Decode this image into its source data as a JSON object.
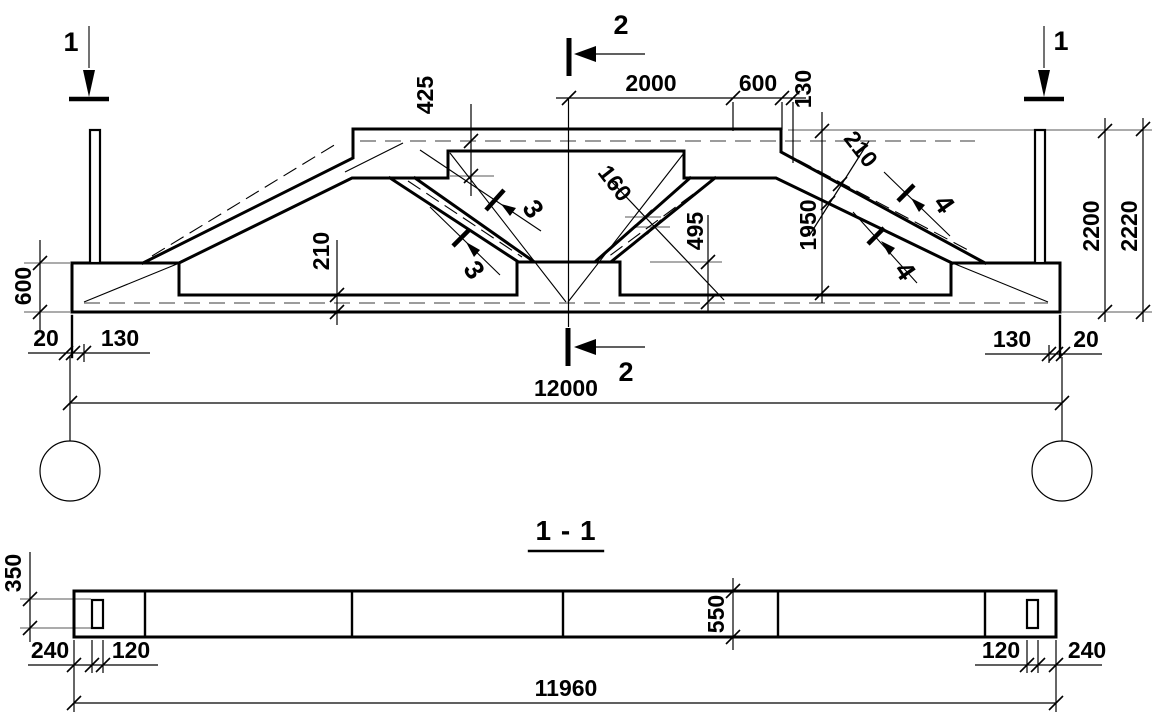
{
  "colors": {
    "ink": "#000000",
    "aux": "#8f8f8f",
    "background": "#ffffff"
  },
  "views": {
    "elevation": {
      "cut_labels": {
        "one": "1",
        "two": "2",
        "three": "3",
        "four": "4"
      },
      "dims": {
        "top_half_span": "2000",
        "top_offset": "600",
        "top_edge": "130",
        "flange_depth": "425",
        "web_thickness": "160",
        "node_height": "495",
        "bottom_chord": "210",
        "top_chord": "210",
        "clear_height": "1950",
        "height": "2200",
        "overall_height": "2220",
        "end_depth": "600",
        "gap_left": "20",
        "edge_left": "130",
        "edge_right": "130",
        "gap_right": "20",
        "span": "12000"
      }
    },
    "section": {
      "title": "1 - 1",
      "dims": {
        "end_width": "350",
        "mid_width": "550",
        "offset_left": "240",
        "hole_left": "120",
        "hole_right": "120",
        "offset_right": "240",
        "length": "11960"
      }
    }
  }
}
